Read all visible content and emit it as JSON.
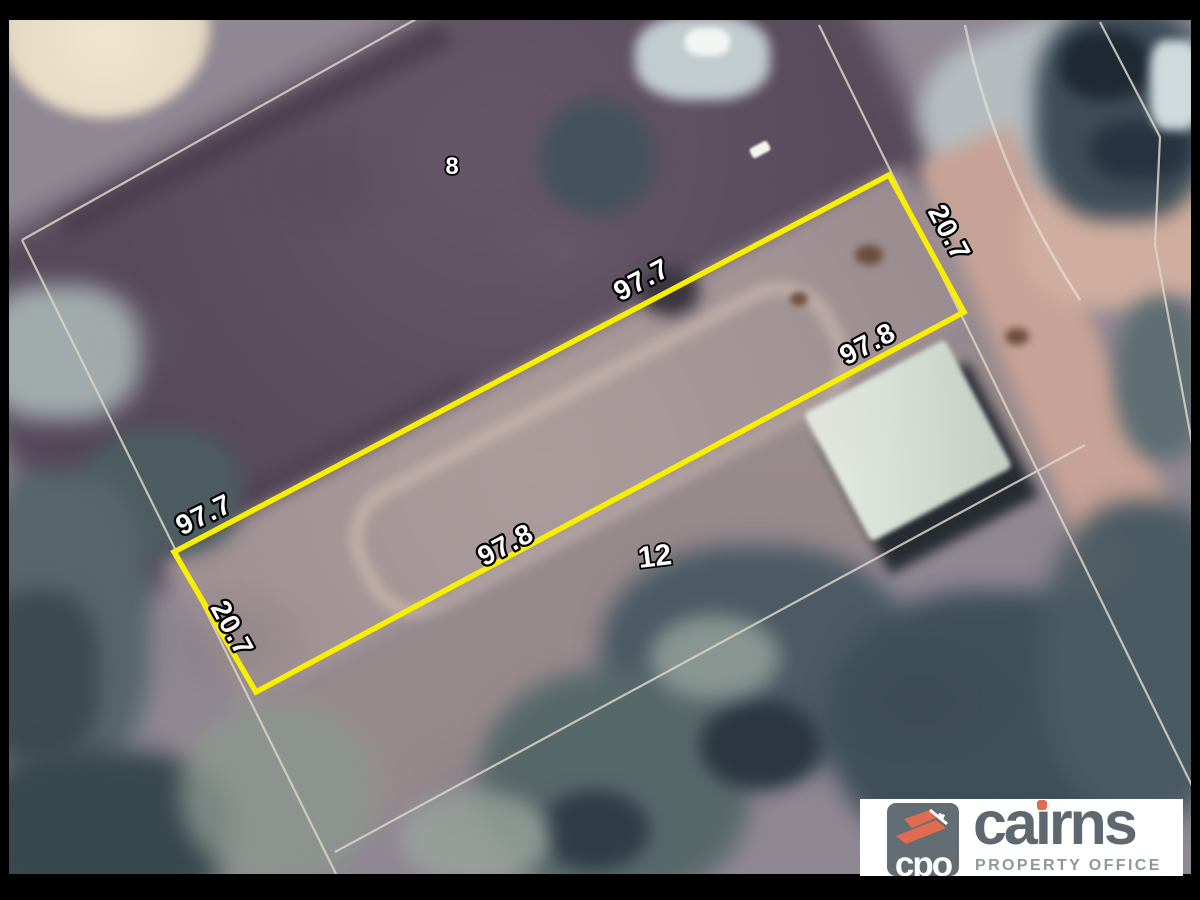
{
  "map": {
    "highlighted_lot": {
      "boundary_color": "#f8ee00",
      "dimensions": [
        {
          "value": "97.7",
          "side": "north-boundary-mid"
        },
        {
          "value": "97.7",
          "side": "north-boundary-west-end"
        },
        {
          "value": "20.7",
          "side": "east-street-boundary"
        },
        {
          "value": "20.7",
          "side": "west-boundary"
        },
        {
          "value": "97.8",
          "side": "south-boundary-east-end"
        },
        {
          "value": "97.8",
          "side": "south-boundary-mid"
        }
      ]
    },
    "neighbour_lot_numbers": [
      {
        "value": "8"
      },
      {
        "value": "12"
      }
    ],
    "cadastral_line_color": "#dcd5c6"
  },
  "logo": {
    "abbr": "cpo",
    "name": "cairns",
    "name_parts": [
      "ca",
      "ı",
      "rns"
    ],
    "tagline": "PROPERTY OFFICE",
    "colors": {
      "orange": "#e06b50",
      "badge_gray": "#646c74",
      "text_gray": "#60686f"
    }
  }
}
